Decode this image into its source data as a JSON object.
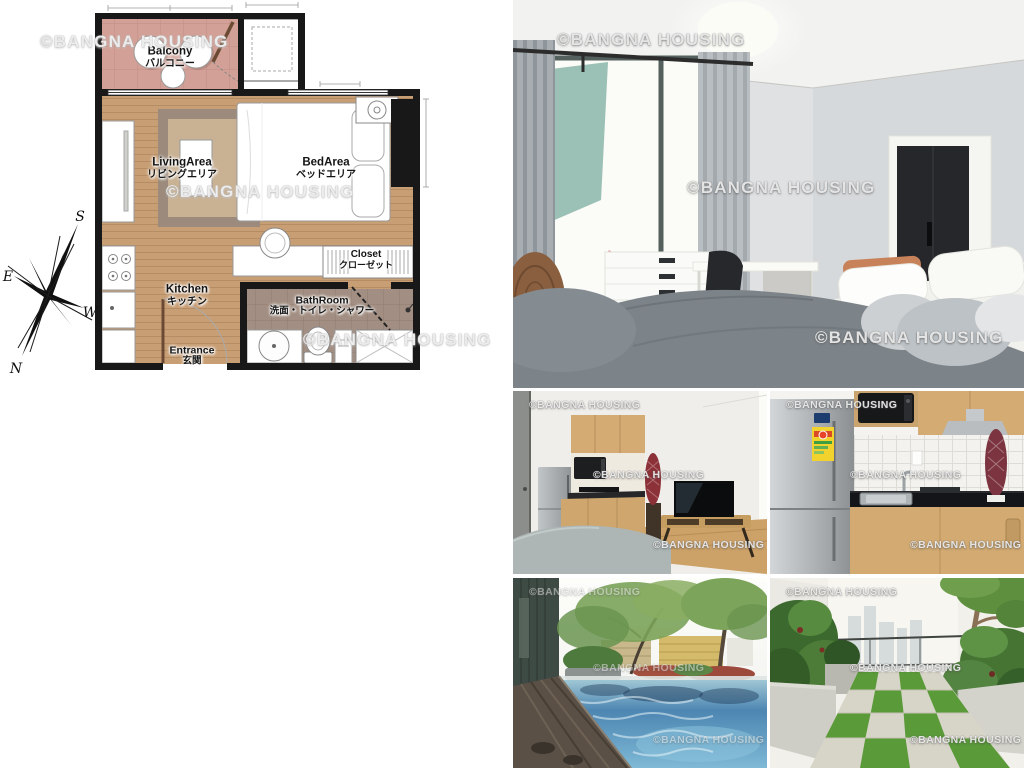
{
  "watermark": {
    "text": "©BANGNA HOUSING"
  },
  "floorplan": {
    "rooms": {
      "balcony": {
        "en": "Balcony",
        "ja": "バルコニー"
      },
      "living": {
        "en": "LivingArea",
        "ja": "リビングエリア"
      },
      "bed": {
        "en": "BedArea",
        "ja": "ベッドエリア"
      },
      "closet": {
        "en": "Closet",
        "ja": "クローゼット"
      },
      "kitchen": {
        "en": "Kitchen",
        "ja": "キッチン"
      },
      "bathroom": {
        "en": "BathRoom",
        "ja": "洗面・トイレ・シャワー"
      },
      "entrance": {
        "en": "Entrance",
        "ja": "玄関"
      }
    },
    "compass": {
      "south": "S",
      "east": "E",
      "west": "W",
      "north": "N"
    },
    "colors": {
      "wall": "#181818",
      "wood_floor": "#c89e74",
      "balcony_tile": "#d2a096",
      "bath_tile": "#a28e82",
      "rug_outer": "#9c8b7c",
      "rug_inner": "#c9b193"
    }
  }
}
